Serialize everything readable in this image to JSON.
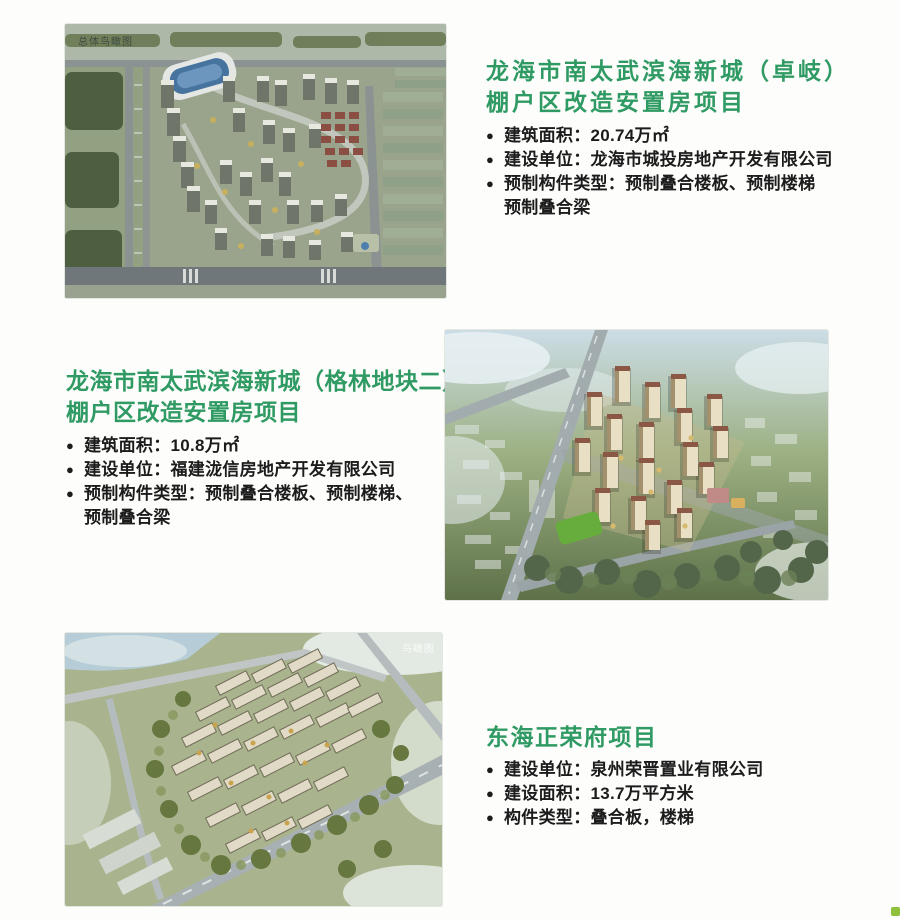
{
  "ui": {
    "bullet": "●"
  },
  "colors": {
    "title_green": "#2f9a63",
    "body_text": "#1c1c1c",
    "page_background": "#fdfdfb",
    "corner_accent": "#8fc03c"
  },
  "projects": [
    {
      "id": "zhuoqi",
      "title_lines": [
        "龙海市南太武滨海新城（卓岐）",
        "棚户区改造安置房项目"
      ],
      "bullets": [
        "建筑面积：20.74万㎡",
        "建设单位：龙海市城投房地产开发有限公司",
        "预制构件类型：预制叠合楼板、预制楼梯"
      ],
      "continuation": "预制叠合梁",
      "image_label": "总体鸟瞰图"
    },
    {
      "id": "gelin",
      "title_lines": [
        "龙海市南太武滨海新城（格林地块二）",
        "棚户区改造安置房项目"
      ],
      "bullets": [
        "建筑面积：10.8万㎡",
        "建设单位：福建泷信房地产开发有限公司",
        "预制构件类型：预制叠合楼板、预制楼梯、"
      ],
      "continuation": "预制叠合梁"
    },
    {
      "id": "donghai",
      "title_lines": [
        "东海正荣府项目"
      ],
      "bullets": [
        "建设单位：泉州荣晋置业有限公司",
        "建设面积：13.7万平方米",
        "构件类型：叠合板，楼梯"
      ],
      "image_label": "鸟瞰图"
    }
  ]
}
